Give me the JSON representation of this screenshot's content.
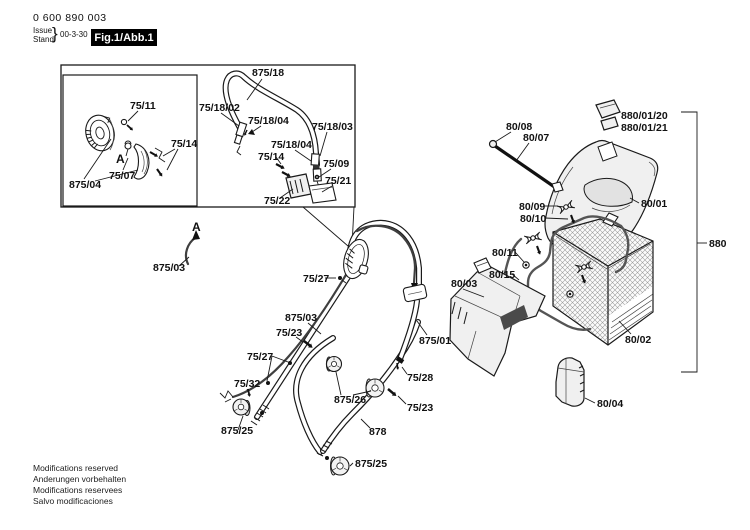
{
  "header": {
    "part_number": "0 600 890 003",
    "issue_label": "Issue",
    "stand_label": "Stand",
    "brace": "}",
    "issue_date": "00-3-30",
    "figure_label": "Fig.1/Abb.1"
  },
  "footer": {
    "lines": [
      "Modifications reserved",
      "Anderungen vorbehalten",
      "Modifications reservees",
      "Salvo modificaciones"
    ]
  },
  "colors": {
    "line": "#1a1a1a",
    "cable": "#3f3f3f",
    "part_fill": "#f0f0f0",
    "badge_bg": "#000000",
    "badge_text": "#ffffff",
    "mesh": "#9a9a9a"
  },
  "callouts": [
    {
      "id": "875-18",
      "text": "875/18",
      "x": 252,
      "y": 76
    },
    {
      "id": "75-18-02",
      "text": "75/18/02",
      "x": 199,
      "y": 111
    },
    {
      "id": "75-18-04-a",
      "text": "75/18/04",
      "x": 248,
      "y": 124
    },
    {
      "id": "75-18-03",
      "text": "75/18/03",
      "x": 312,
      "y": 130
    },
    {
      "id": "75-18-04-b",
      "text": "75/18/04",
      "x": 271,
      "y": 148
    },
    {
      "id": "75-14-cable",
      "text": "75/14",
      "x": 258,
      "y": 160
    },
    {
      "id": "75-09",
      "text": "75/09",
      "x": 323,
      "y": 167
    },
    {
      "id": "75-21",
      "text": "75/21",
      "x": 325,
      "y": 184
    },
    {
      "id": "75-22",
      "text": "75/22",
      "x": 264,
      "y": 204
    },
    {
      "id": "75-11",
      "text": "75/11",
      "x": 130,
      "y": 109
    },
    {
      "id": "detail-a-inset",
      "text": "A",
      "x": 116,
      "y": 163,
      "large": true
    },
    {
      "id": "75-07",
      "text": "75/07",
      "x": 109,
      "y": 179
    },
    {
      "id": "875-04",
      "text": "875/04",
      "x": 69,
      "y": 188
    },
    {
      "id": "75-14-inset",
      "text": "75/14",
      "x": 171,
      "y": 147
    },
    {
      "id": "detail-a-cable",
      "text": "A",
      "x": 192,
      "y": 231,
      "large": true
    },
    {
      "id": "875-03-a",
      "text": "875/03",
      "x": 153,
      "y": 271
    },
    {
      "id": "75-27-upper",
      "text": "75/27",
      "x": 303,
      "y": 282
    },
    {
      "id": "875-03-main",
      "text": "875/03",
      "x": 285,
      "y": 321
    },
    {
      "id": "75-23-mid",
      "text": "75/23",
      "x": 276,
      "y": 336
    },
    {
      "id": "75-27-lower",
      "text": "75/27",
      "x": 247,
      "y": 360
    },
    {
      "id": "75-32",
      "text": "75/32",
      "x": 234,
      "y": 387
    },
    {
      "id": "875-25-left",
      "text": "875/25",
      "x": 221,
      "y": 434
    },
    {
      "id": "875-26",
      "text": "875/26",
      "x": 334,
      "y": 403
    },
    {
      "id": "878",
      "text": "878",
      "x": 369,
      "y": 435
    },
    {
      "id": "875-25-bottom",
      "text": "875/25",
      "x": 355,
      "y": 467
    },
    {
      "id": "875-01",
      "text": "875/01",
      "x": 419,
      "y": 344
    },
    {
      "id": "75-28",
      "text": "75/28",
      "x": 407,
      "y": 381
    },
    {
      "id": "75-23-right",
      "text": "75/23",
      "x": 407,
      "y": 411
    },
    {
      "id": "80-08",
      "text": "80/08",
      "x": 506,
      "y": 130
    },
    {
      "id": "80-07",
      "text": "80/07",
      "x": 523,
      "y": 141
    },
    {
      "id": "880-01-20",
      "text": "880/01/20",
      "x": 621,
      "y": 119
    },
    {
      "id": "880-01-21",
      "text": "880/01/21",
      "x": 621,
      "y": 131
    },
    {
      "id": "80-01",
      "text": "80/01",
      "x": 641,
      "y": 207
    },
    {
      "id": "80-09",
      "text": "80/09",
      "x": 519,
      "y": 210
    },
    {
      "id": "80-10",
      "text": "80/10",
      "x": 520,
      "y": 222
    },
    {
      "id": "80-11",
      "text": "80/11",
      "x": 492,
      "y": 256
    },
    {
      "id": "80-15",
      "text": "80/15",
      "x": 489,
      "y": 278
    },
    {
      "id": "80-03",
      "text": "80/03",
      "x": 451,
      "y": 287
    },
    {
      "id": "80-02",
      "text": "80/02",
      "x": 625,
      "y": 343
    },
    {
      "id": "80-04",
      "text": "80/04",
      "x": 597,
      "y": 407
    },
    {
      "id": "880",
      "text": "880",
      "x": 709,
      "y": 247
    }
  ]
}
